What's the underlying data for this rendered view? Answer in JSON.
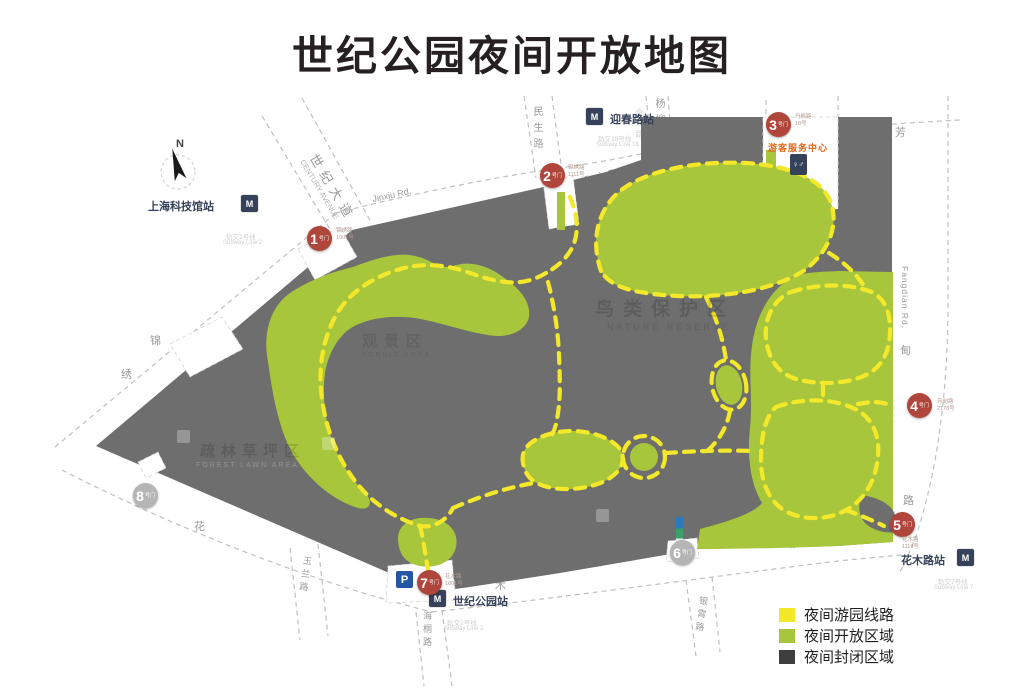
{
  "title": "世纪公园夜间开放地图",
  "legend": {
    "route": "夜间游园线路",
    "open": "夜间开放区域",
    "closed": "夜间封闭区域"
  },
  "compass_n": "N",
  "gates": [
    {
      "number": "1",
      "label": "号门",
      "address": "锦绣路",
      "address_no": "1001号"
    },
    {
      "number": "2",
      "label": "号门",
      "address": "锦绣路",
      "address_no": "1111号"
    },
    {
      "number": "3",
      "label": "号门",
      "address": "丹枫路",
      "address_no": "18号"
    },
    {
      "number": "4",
      "label": "号门",
      "address": "芳甸路",
      "address_no": "2178号"
    },
    {
      "number": "5",
      "label": "号门",
      "address": "花木路",
      "address_no": "1119号"
    },
    {
      "number": "6",
      "label": "号门",
      "address": "",
      "address_no": ""
    },
    {
      "number": "7",
      "label": "号门",
      "address": "花木路",
      "address_no": "1001号"
    },
    {
      "number": "8",
      "label": "号门",
      "address": "",
      "address_no": ""
    }
  ],
  "stations": [
    {
      "name": "上海科技馆站",
      "line": "轨交2号线",
      "line_en": "Subway Line 2"
    },
    {
      "name": "迎春路站",
      "line": "轨交18号线",
      "line_en": "Subway Line 18"
    },
    {
      "name": "世纪公园站",
      "line": "轨交2号线",
      "line_en": "Subway Line 2"
    },
    {
      "name": "花木路站",
      "line": "轨交7号线",
      "line_en": "Subway Line 7"
    }
  ],
  "roads": {
    "century_cn": "世纪大道",
    "century_en": "CENTURY AVENUE",
    "jinxiu_en": "Jinxiu Rd.",
    "jinxiu_c1": "锦",
    "jinxiu_c2": "绣",
    "jinxiu_c3": "路",
    "minsheng": "民生路",
    "yangliu": "杨柳路",
    "hehuan": "合欢路",
    "fangdian_en": "Fangdian Rd.",
    "fangdian_c1": "芳",
    "fangdian_c2": "甸",
    "fangdian_c3": "路",
    "huamu_en": "Huamu Rd.",
    "huamu_c1": "花",
    "huamu_c2": "木",
    "huamu_c3": "路",
    "yulan": "玉兰路",
    "haitong": "海桐路",
    "yinxiao": "银霄路"
  },
  "areas": [
    {
      "cn": "鸟类保护区",
      "en": "NATURE RESERVE"
    },
    {
      "cn": "观景区",
      "en": "SCENIC AREA"
    },
    {
      "cn": "疏林草坪区",
      "en": "FOREST LAWN AREA"
    }
  ],
  "poi": {
    "service_center": "游客服务中心",
    "parking": "P",
    "metro": "M",
    "toilet": "♀♂"
  },
  "colors": {
    "open_area": "#a8c63c",
    "closed_area_map": "#6e6e6e",
    "closed_area_legend": "#3e3e3e",
    "route_yellow": "#f3e92a",
    "gate_open": "#b0453b",
    "gate_closed": "#b5b5b5",
    "metro_icon": "#36425a",
    "parking_icon": "#2456a4",
    "service_text": "#e2661b"
  }
}
